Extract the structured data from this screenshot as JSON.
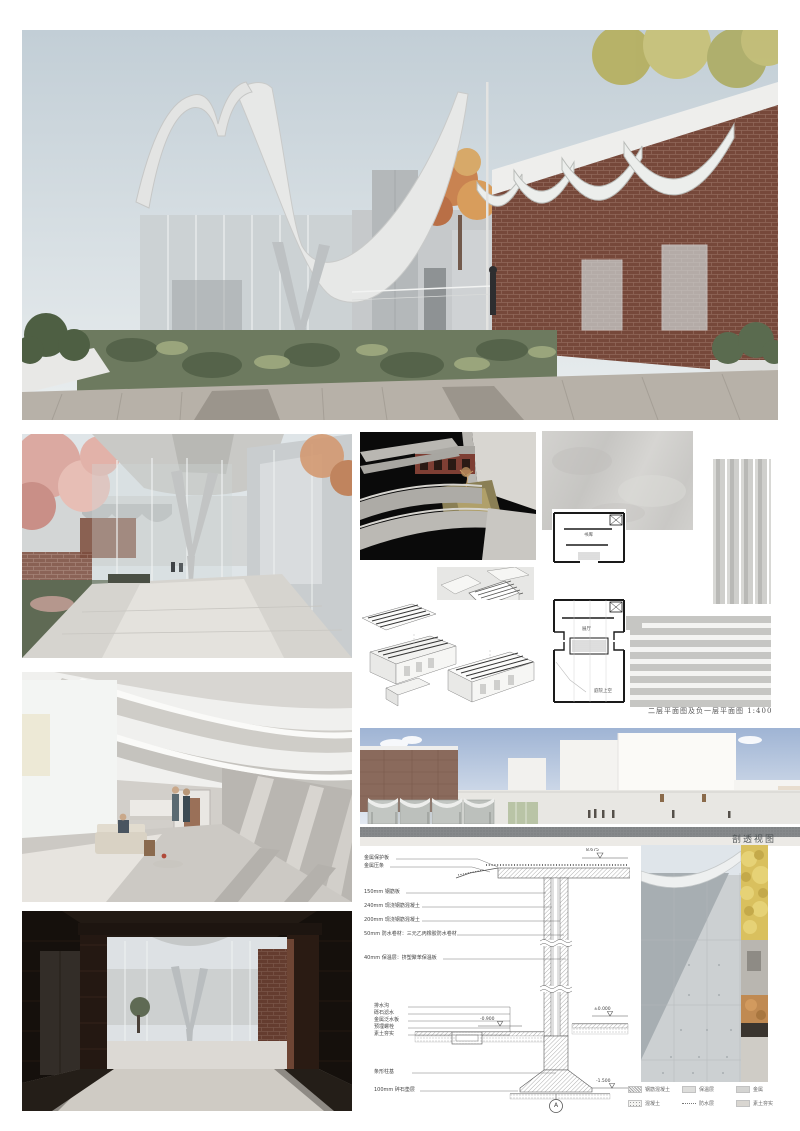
{
  "board": {
    "kind": "architecture-presentation-board"
  },
  "captions": {
    "plan_caption": "二层平面图及负一层平面图 1:400",
    "section_label": "剖透视图"
  },
  "plans": {
    "upper_room_label": "书库",
    "lower_room_label": "展厅",
    "void_label": "庭院上空"
  },
  "detail": {
    "upper_callouts": [
      "金属保护板",
      "金属压条",
      "150mm 钢筋板",
      "240mm 现浇钢筋混凝土",
      "200mm 现浇钢筋混凝土",
      "50mm 防水卷材：三元乙丙橡胶防水卷材",
      "40mm 保温层：挤塑聚苯保温板"
    ],
    "lower_callouts": [
      "排水沟",
      "砾石滤水",
      "金属泛水板",
      "预埋螺栓",
      "素土夯实"
    ],
    "foundation_callouts": [
      "条形柱基",
      "100mm 碎石垫层"
    ],
    "elevations": {
      "roof": "8.675",
      "floor_left": "-0.900",
      "floor_right": "±0.000",
      "base": "-1.500"
    },
    "bubble_label": "A"
  },
  "legend": {
    "items": [
      {
        "swatch": "hatch",
        "label": "钢筋混凝土"
      },
      {
        "swatch": "solid",
        "label": "保温层"
      },
      {
        "swatch": "metal",
        "label": "金属"
      },
      {
        "swatch": "dots",
        "label": "混凝土"
      },
      {
        "swatch": "dash",
        "label": "防水层"
      },
      {
        "swatch": "earth",
        "label": "素土夯实"
      }
    ]
  },
  "colors": {
    "brick": "#7c4c3d",
    "concrete": "#c6c9cb",
    "hero_sky": "#c2ced6",
    "section_sky": "#9fb4d4",
    "ground_band": "#5d6164",
    "foliage_yellow": "#d9c05e",
    "foliage_pink": "#dba9a1"
  }
}
